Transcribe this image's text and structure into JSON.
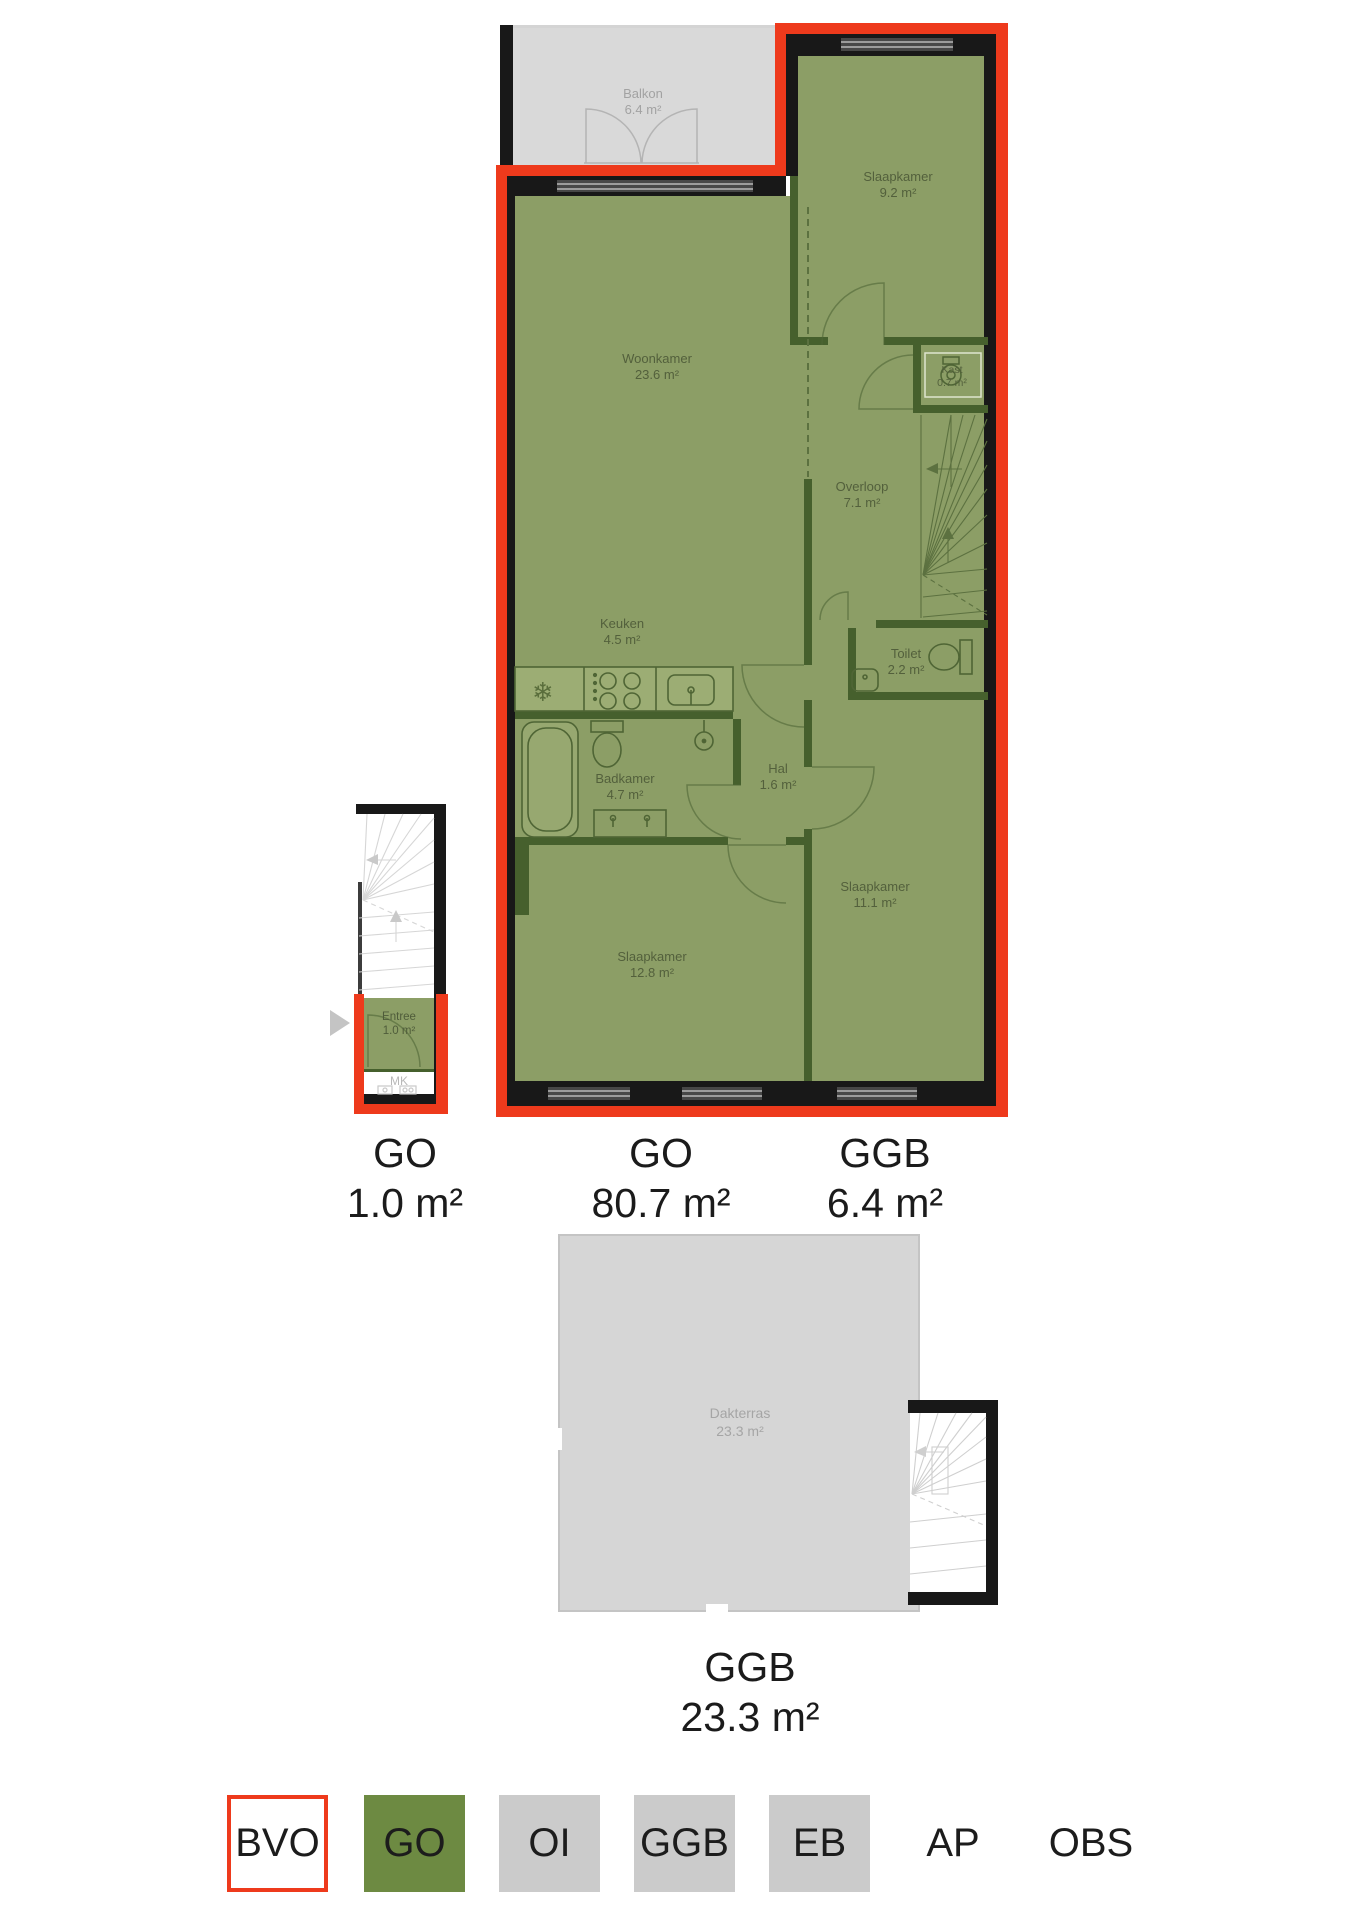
{
  "rooms": {
    "balkon": {
      "name": "Balkon",
      "area": "6.4 m²"
    },
    "slaapkamer_1": {
      "name": "Slaapkamer",
      "area": "9.2 m²"
    },
    "woonkamer": {
      "name": "Woonkamer",
      "area": "23.6 m²"
    },
    "kast": {
      "name": "Kast",
      "area": "0.7 m²"
    },
    "overloop": {
      "name": "Overloop",
      "area": "7.1 m²"
    },
    "keuken": {
      "name": "Keuken",
      "area": "4.5 m²"
    },
    "toilet": {
      "name": "Toilet",
      "area": "2.2 m²"
    },
    "badkamer": {
      "name": "Badkamer",
      "area": "4.7 m²"
    },
    "hal": {
      "name": "Hal",
      "area": "1.6 m²"
    },
    "slaapkamer_2": {
      "name": "Slaapkamer",
      "area": "12.8 m²"
    },
    "slaapkamer_3": {
      "name": "Slaapkamer",
      "area": "11.1 m²"
    },
    "entree": {
      "name": "Entree",
      "area": "1.0 m²"
    },
    "mk": {
      "name": "MK"
    },
    "dakterras": {
      "name": "Dakterras",
      "area": "23.3 m²"
    }
  },
  "area_labels": {
    "entry": {
      "code": "GO",
      "area": "1.0 m²"
    },
    "main": {
      "code": "GO",
      "area": "80.7 m²"
    },
    "balcony": {
      "code": "GGB",
      "area": "6.4 m²"
    },
    "roof": {
      "code": "GGB",
      "area": "23.3 m²"
    }
  },
  "legend": {
    "items": [
      {
        "code": "BVO",
        "swatch": "red-outline"
      },
      {
        "code": "GO",
        "swatch": "green"
      },
      {
        "code": "OI",
        "swatch": "gray"
      },
      {
        "code": "GGB",
        "swatch": "gray"
      },
      {
        "code": "EB",
        "swatch": "gray"
      },
      {
        "code": "AP",
        "swatch": "none"
      },
      {
        "code": "OBS",
        "swatch": "none"
      }
    ]
  },
  "colors": {
    "bvo_outline": "#ee3a1c",
    "go_fill": "#8c9e66",
    "legend_go": "#6d8a42",
    "surface_gray": "#d9d9d9",
    "legend_gray": "#cbcbcb",
    "wall_black": "#181818",
    "wall_inner": "#46602d"
  }
}
